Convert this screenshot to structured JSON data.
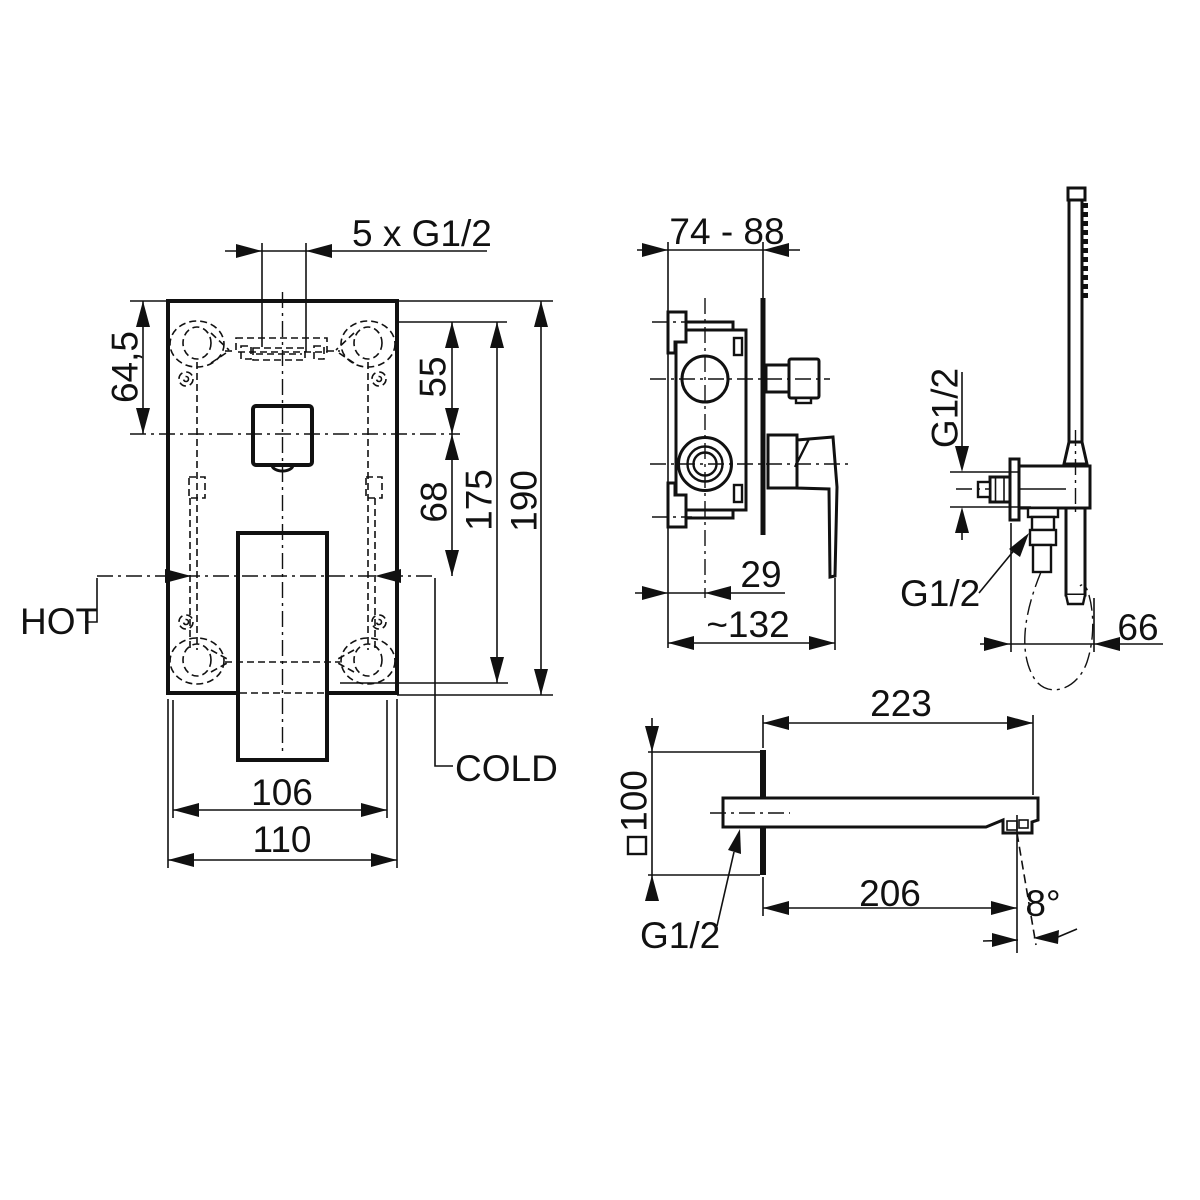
{
  "drawing": {
    "background": "#ffffff",
    "line_color": "#111111",
    "views": {
      "front_plate": {
        "name": "concealed-mixer-front-view",
        "labels": {
          "ports": "5 x G1/2",
          "top_height": "64,5",
          "upper_spacing": "55",
          "lower_spacing": "68",
          "hole_span": "175",
          "total_height": "190",
          "hot": "HOT",
          "cold": "COLD",
          "inner_width": "106",
          "total_width": "110"
        }
      },
      "valve_side": {
        "name": "valve-body-side-view",
        "labels": {
          "install_depth": "74 - 88",
          "wall_to_axis": "29",
          "total_depth": "~132"
        }
      },
      "hand_shower": {
        "name": "hand-shower-with-holder",
        "labels": {
          "holder_thread": "G1/2",
          "hose_thread": "G1/2",
          "offset": "66"
        }
      },
      "spout": {
        "name": "bath-spout-side-view",
        "labels": {
          "total_length": "223",
          "escutcheon_size": "100",
          "outlet_distance": "206",
          "outlet_angle": "8°",
          "thread": "G1/2"
        }
      }
    }
  }
}
